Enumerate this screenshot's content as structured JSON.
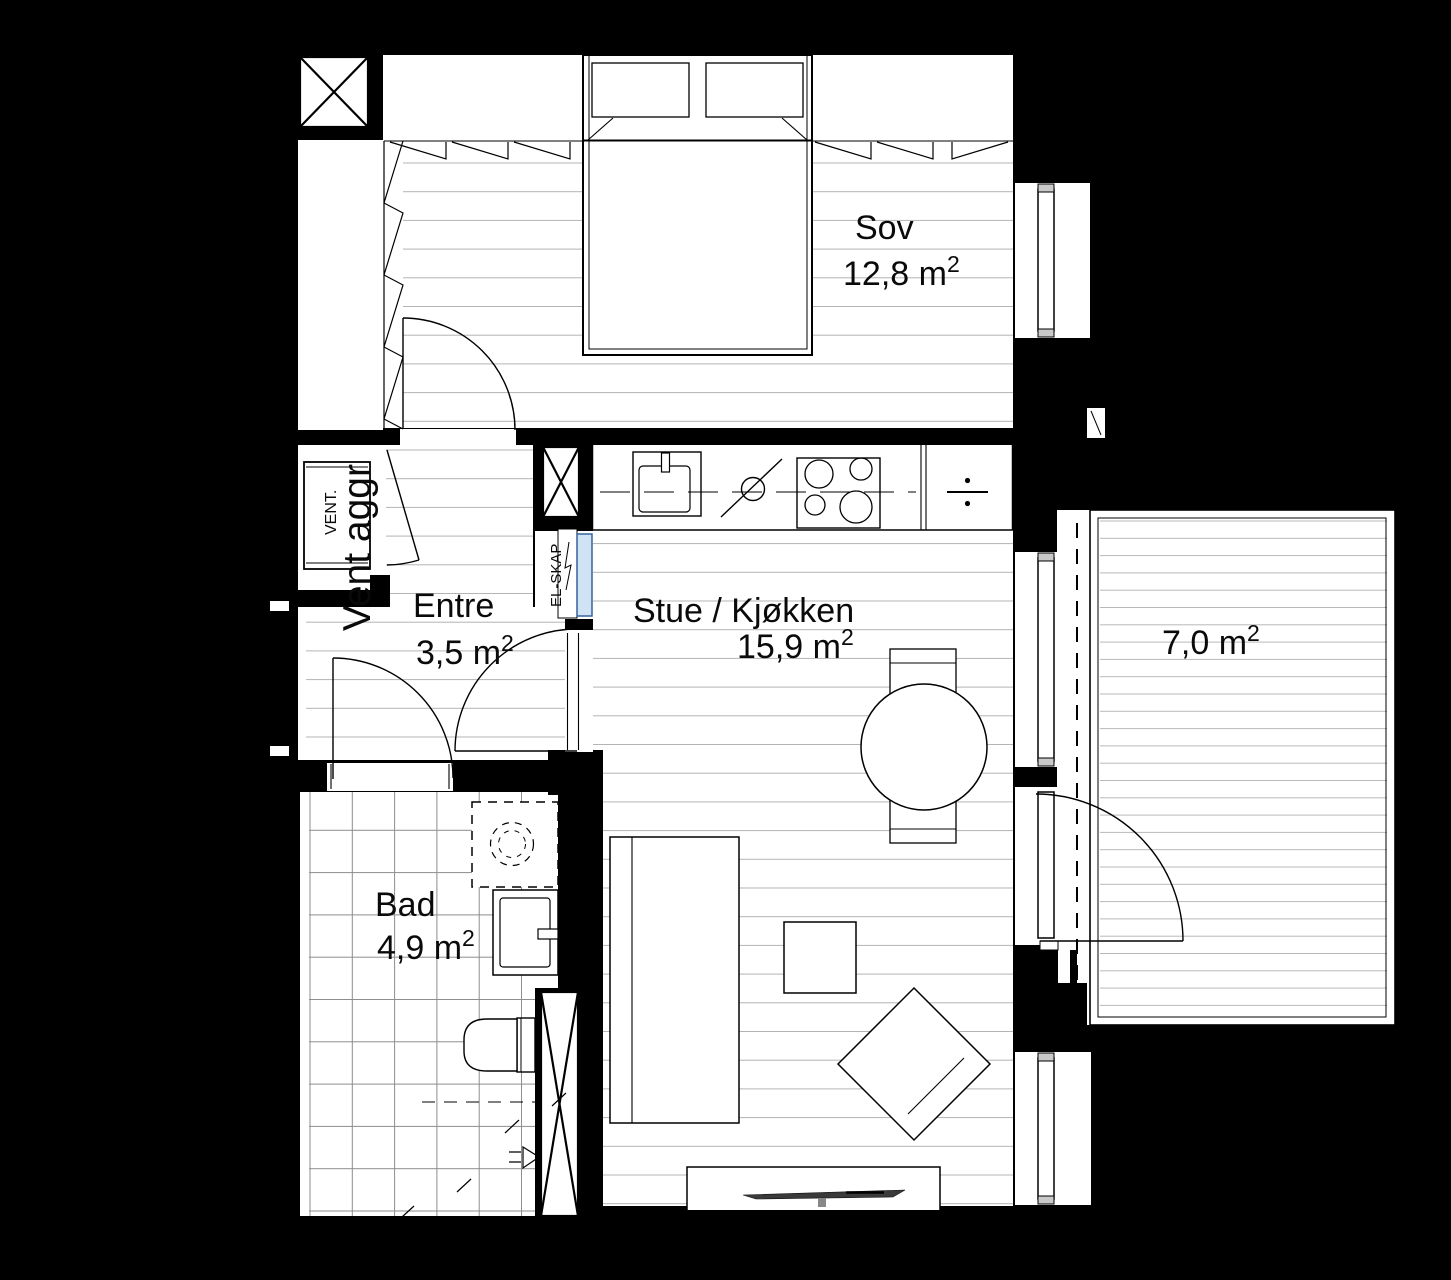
{
  "document": {
    "type": "architectural-floor-plan",
    "language": "Norwegian"
  },
  "rooms": [
    {
      "id": "sov",
      "label": "Sov",
      "area_value": "12,8 m",
      "area_sup": "2"
    },
    {
      "id": "stue-kjokken",
      "label": "Stue / Kjøkken",
      "area_value": "15,9 m",
      "area_sup": "2"
    },
    {
      "id": "entre",
      "label": "Entre",
      "area_value": "3,5 m",
      "area_sup": "2"
    },
    {
      "id": "bad",
      "label": "Bad",
      "area_value": "4,9 m",
      "area_sup": "2"
    },
    {
      "id": "balkong",
      "label": "",
      "area_value": "7,0 m",
      "area_sup": "2"
    }
  ],
  "annotations": {
    "vent_small": "VENT.",
    "vent_big": "Vent aggr",
    "el_skap": "EL-SKAP"
  },
  "colors": {
    "background": "#000000",
    "floor": "#ffffff",
    "lines": "#000000",
    "floor_hatch": "#b3b3b3",
    "tile_grid": "#8d8d8d",
    "el_skap_fill": "#cfe3f5",
    "el_skap_stroke": "#35639c",
    "tv_fill": "#3a3a3a"
  }
}
